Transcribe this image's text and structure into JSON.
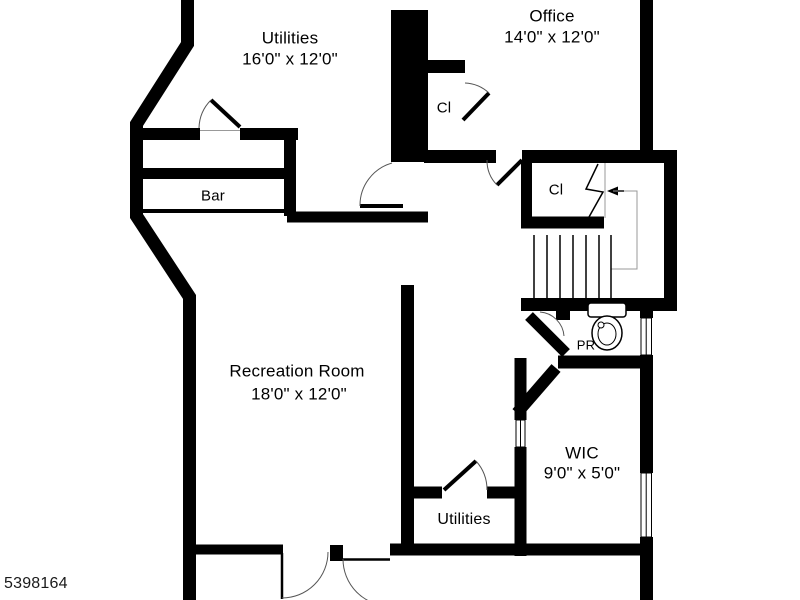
{
  "plan": {
    "watermark": "5398164",
    "rooms": {
      "utilities_top": {
        "name": "Utilities",
        "dims": "16'0\" x 12'0\""
      },
      "office": {
        "name": "Office",
        "dims": "14'0\" x 12'0\""
      },
      "closet_top": {
        "name": "Cl"
      },
      "closet_hall": {
        "name": "Cl"
      },
      "bar": {
        "name": "Bar"
      },
      "recreation": {
        "name": "Recreation Room",
        "dims": "18'0\" x 12'0\""
      },
      "powder_room": {
        "name": "PR",
        "dims": "4'0\" x 4'0\""
      },
      "wic": {
        "name": "WIC",
        "dims": "9'0\" x 5'0\""
      },
      "utilities_bottom": {
        "name": "Utilities"
      }
    },
    "colors": {
      "wall": "#000000",
      "background": "#ffffff",
      "guide": "#999999"
    }
  }
}
